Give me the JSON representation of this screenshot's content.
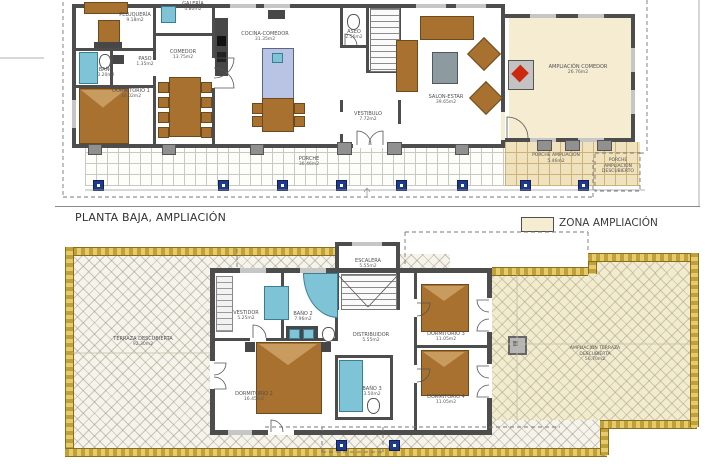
{
  "title": "PLANTA BAJA, AMPLIACIÓN",
  "legend": {
    "label": "ZONA AMPLIACIÓN",
    "swatch_color": "#f5ecd2"
  },
  "colors": {
    "wall": "#4d4d4d",
    "ampliacion_fill": "#f5ecd2",
    "gold_border": "#c2a038",
    "column_blue": "#1e3a8f",
    "furniture_wood": "#a9712f",
    "fixture_blue": "#7fc3d6",
    "fireplace_red": "#cc2a10"
  },
  "ground": {
    "rooms": {
      "peluqueria": {
        "name": "PELUQUERÍA",
        "area": "9.18m2"
      },
      "galeria": {
        "name": "GALERÍA",
        "area": "4.80m2"
      },
      "bano": {
        "name": "BAÑO",
        "area": "3.20m2"
      },
      "paso": {
        "name": "PASO",
        "area": "1.35m2"
      },
      "comedor": {
        "name": "COMEDOR",
        "area": "13.75m2"
      },
      "dormitorio1": {
        "name": "DORMITORIO 1",
        "area": "10.02m2"
      },
      "cocina_comedor": {
        "name": "COCINA-COMEDOR",
        "area": "31.35m2"
      },
      "aseo": {
        "name": "ASEO",
        "area": "2.56m2"
      },
      "salon_estar": {
        "name": "SALON-ESTAR",
        "area": "39.65m2"
      },
      "vestibulo": {
        "name": "VESTIBULO",
        "area": "7.72m2"
      },
      "ampliacion_comedor": {
        "name": "AMPLIACIÓN COMEDOR",
        "area": "26.76m2"
      },
      "porche": {
        "name": "PORCHE",
        "area": "36.46m2"
      },
      "porche_ampliacion": {
        "name": "PORCHE AMPLIACIÓN",
        "area": "5.46m2"
      },
      "porche_ampliacion_descubierto": {
        "name": "PORCHE AMPLIACIÓN DESCUBIERTO",
        "area": ""
      }
    }
  },
  "upper": {
    "rooms": {
      "escalera": {
        "name": "ESCALERA",
        "area": "5.55m2"
      },
      "vestidor": {
        "name": "VESTIDOR",
        "area": "5.25m2"
      },
      "bano2": {
        "name": "BAÑO 2",
        "area": "7.96m2"
      },
      "distribuidor": {
        "name": "DISTRIBUIDOR",
        "area": "5.55m2"
      },
      "dormitorio2": {
        "name": "DORMITORIO 2",
        "area": "16.45m2"
      },
      "bano3": {
        "name": "BAÑO 3",
        "area": "3.50m2"
      },
      "dormitorio3": {
        "name": "DORMITORIO 3",
        "area": "11.05m2"
      },
      "dormitorio4": {
        "name": "DORMITORIO 4",
        "area": "11.05m2"
      },
      "terraza": {
        "name": "TERRAZA DESCUBIERTA",
        "area": "92.30m2"
      },
      "ampliacion_terraza": {
        "name": "AMPLIACIÓN TERRAZA DESCUBIERTA",
        "area": "56.70m2"
      }
    }
  }
}
